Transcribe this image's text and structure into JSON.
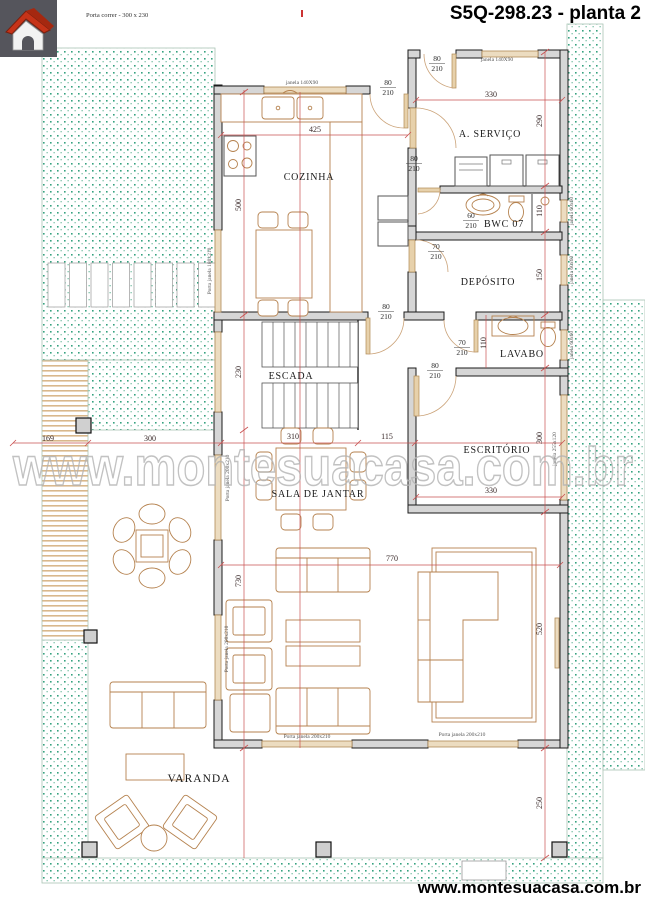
{
  "header": {
    "door_annotation": "Porta correr - 300 x 230",
    "title": "S5Q-298.23 - planta 2"
  },
  "footer": {
    "site": "www.montesuacasa.com.br"
  },
  "watermark": {
    "text": "www.montesuacasa.com.br"
  },
  "rooms": {
    "cozinha": "COZINHA",
    "servico": "A. SERVIÇO",
    "bwc": "BWC 07",
    "deposito": "DEPÓSITO",
    "lavabo": "LAVABO",
    "escada": "ESCADA",
    "escritorio": "ESCRITÓRIO",
    "sala_jantar": "SALA DE JANTAR",
    "varanda": "VARANDA"
  },
  "doors": {
    "d80": {
      "w": "80",
      "h": "210"
    },
    "d70": {
      "w": "70",
      "h": "210"
    },
    "d60": {
      "w": "60",
      "h": "210"
    }
  },
  "windows": {
    "janela_140x90": "janela 140X90",
    "janela_60x60": "janela 60x60",
    "janela_255x120": "janela 255x120",
    "porta_janela_180x210": "Porta janela 180x210",
    "porta_janela_200x210": "Porta janela 200x210"
  },
  "dims": {
    "kitchen_width": "425",
    "kitchen_depth": "500",
    "service_width": "330",
    "service_depth": "290",
    "bwc_depth": "110",
    "deposito_depth": "150",
    "lavabo_depth": "110",
    "stairs_depth": "230",
    "sala_width": "310",
    "hall_width": "115",
    "escritorio_width": "330",
    "escritorio_depth": "300",
    "living_width": "770",
    "living_depth": "730",
    "living_right_depth": "520",
    "terrace_depth": "250",
    "varanda_left": "169",
    "deck_width": "300"
  },
  "colors": {
    "dimension_line": "#c95050",
    "furniture": "#b5824f",
    "wall_fill": "#d6d6d6",
    "grass_dot": "#35a27f",
    "logo_roof": "#c63318"
  }
}
